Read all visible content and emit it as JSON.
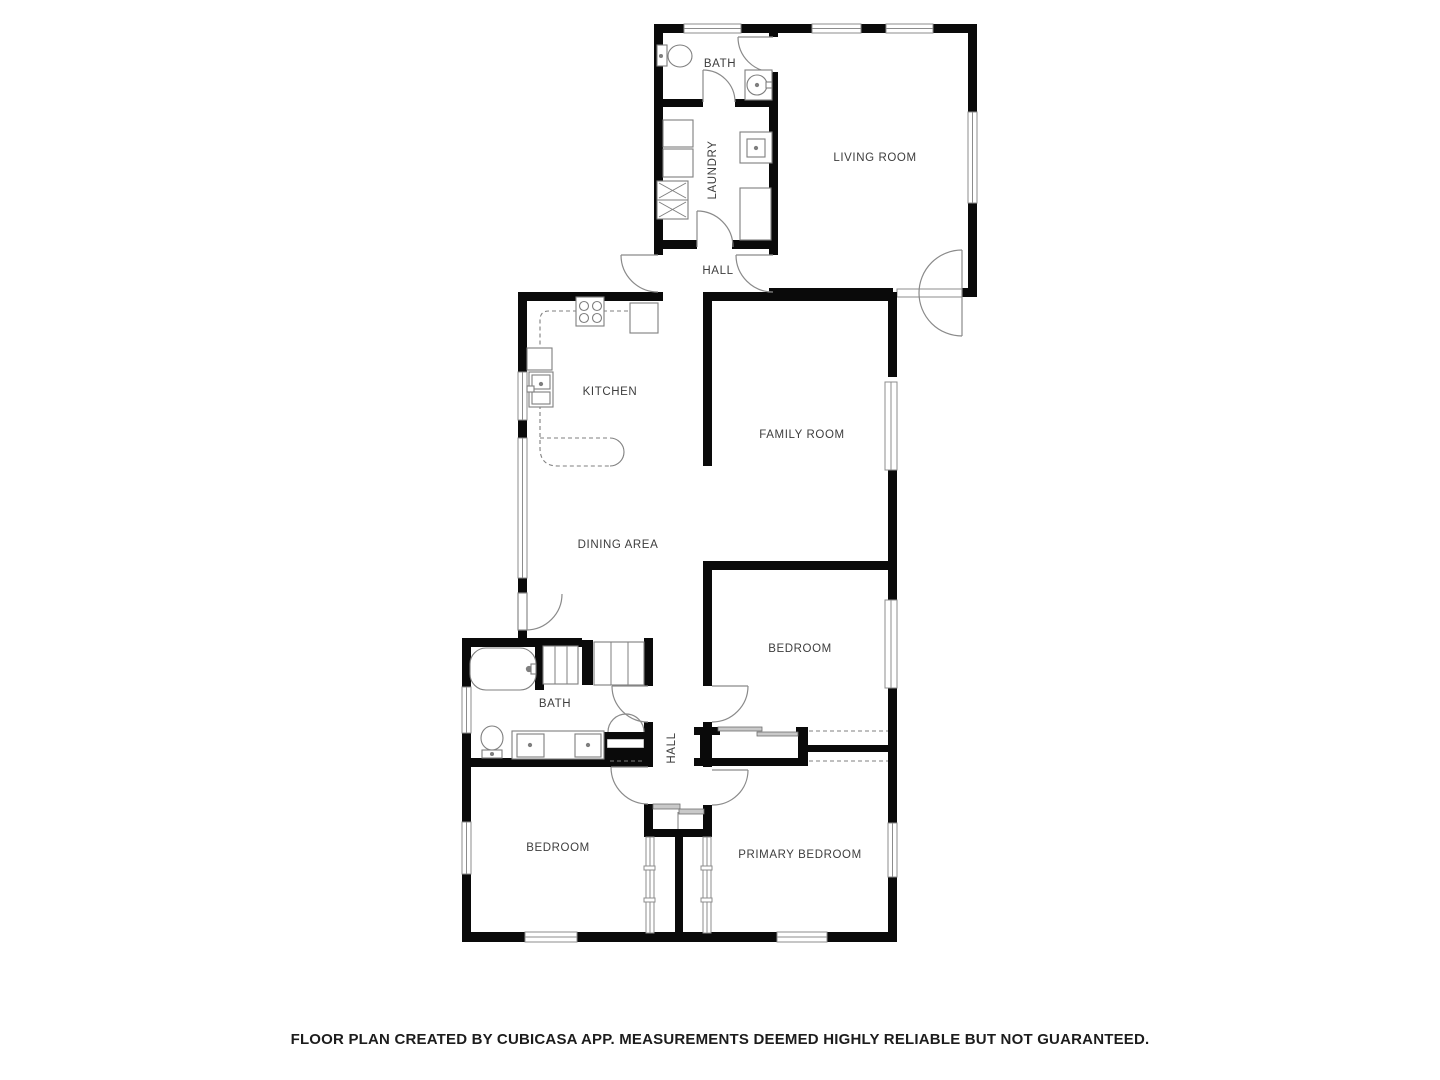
{
  "footer": {
    "disclaimer": "FLOOR PLAN CREATED BY CUBICASA APP. MEASUREMENTS DEEMED HIGHLY RELIABLE BUT NOT GUARANTEED."
  },
  "floorplan": {
    "canvas": {
      "width": 1440,
      "height": 1080
    },
    "colors": {
      "wall": "#0a0a0a",
      "window_stroke": "#8c8c8c",
      "door": "#8a8a8a",
      "fixture": "#7f7f7f",
      "label": "#3d3d3d",
      "slider_fill": "#c9c9c9",
      "background": "#ffffff"
    },
    "rooms": [
      {
        "id": "bath-upper",
        "label": "BATH",
        "x": 720,
        "y": 67,
        "rotate": 0
      },
      {
        "id": "laundry",
        "label": "LAUNDRY",
        "x": 716,
        "y": 170,
        "rotate": -90
      },
      {
        "id": "living-room",
        "label": "LIVING ROOM",
        "x": 875,
        "y": 161,
        "rotate": 0
      },
      {
        "id": "hall-upper",
        "label": "HALL",
        "x": 718,
        "y": 274,
        "rotate": 0
      },
      {
        "id": "kitchen",
        "label": "KITCHEN",
        "x": 610,
        "y": 395,
        "rotate": 0
      },
      {
        "id": "family-room",
        "label": "FAMILY ROOM",
        "x": 802,
        "y": 438,
        "rotate": 0
      },
      {
        "id": "dining-area",
        "label": "DINING AREA",
        "x": 618,
        "y": 548,
        "rotate": 0
      },
      {
        "id": "bedroom-right",
        "label": "BEDROOM",
        "x": 800,
        "y": 652,
        "rotate": 0
      },
      {
        "id": "bath-lower",
        "label": "BATH",
        "x": 555,
        "y": 707,
        "rotate": 0
      },
      {
        "id": "hall-lower",
        "label": "HALL",
        "x": 675,
        "y": 748,
        "rotate": -90
      },
      {
        "id": "bedroom-left",
        "label": "BEDROOM",
        "x": 558,
        "y": 851,
        "rotate": 0
      },
      {
        "id": "primary-bedroom",
        "label": "PRIMARY BEDROOM",
        "x": 800,
        "y": 858,
        "rotate": 0
      }
    ],
    "walls": [
      [
        654,
        24,
        30,
        9
      ],
      [
        741,
        24,
        71,
        9
      ],
      [
        861,
        24,
        25,
        9
      ],
      [
        933,
        24,
        44,
        9
      ],
      [
        654,
        24,
        9,
        231
      ],
      [
        769,
        24,
        9,
        13
      ],
      [
        769,
        72,
        9,
        183
      ],
      [
        769,
        288,
        9,
        9
      ],
      [
        654,
        99,
        49,
        8
      ],
      [
        735,
        99,
        43,
        8
      ],
      [
        654,
        240,
        43,
        9
      ],
      [
        732,
        240,
        46,
        9
      ],
      [
        968,
        24,
        9,
        88
      ],
      [
        968,
        203,
        9,
        85
      ],
      [
        962,
        288,
        15,
        9
      ],
      [
        778,
        288,
        115,
        9
      ],
      [
        703,
        292,
        190,
        9
      ],
      [
        518,
        292,
        145,
        9
      ],
      [
        518,
        292,
        9,
        80
      ],
      [
        518,
        420,
        9,
        18
      ],
      [
        518,
        578,
        9,
        15
      ],
      [
        518,
        630,
        9,
        17
      ],
      [
        703,
        292,
        9,
        174
      ],
      [
        888,
        292,
        9,
        85
      ],
      [
        888,
        470,
        9,
        100
      ],
      [
        703,
        561,
        194,
        9
      ],
      [
        703,
        561,
        9,
        125
      ],
      [
        703,
        722,
        9,
        45
      ],
      [
        703,
        805,
        9,
        32
      ],
      [
        888,
        570,
        9,
        30
      ],
      [
        888,
        688,
        9,
        135
      ],
      [
        888,
        877,
        9,
        55
      ],
      [
        694,
        727,
        26,
        8
      ],
      [
        796,
        727,
        12,
        8
      ],
      [
        694,
        758,
        114,
        8
      ],
      [
        808,
        745,
        89,
        7
      ],
      [
        700,
        727,
        8,
        39
      ],
      [
        798,
        727,
        10,
        39
      ],
      [
        644,
        638,
        9,
        48
      ],
      [
        644,
        722,
        9,
        45
      ],
      [
        644,
        804,
        9,
        33
      ],
      [
        645,
        829,
        67,
        8
      ],
      [
        462,
        638,
        120,
        9
      ],
      [
        582,
        640,
        11,
        45
      ],
      [
        535,
        640,
        9,
        50
      ],
      [
        462,
        645,
        9,
        42
      ],
      [
        462,
        733,
        9,
        89
      ],
      [
        462,
        874,
        9,
        58
      ],
      [
        462,
        758,
        182,
        9
      ],
      [
        598,
        732,
        9,
        31
      ],
      [
        598,
        732,
        55,
        7
      ],
      [
        598,
        748,
        55,
        10
      ],
      [
        675,
        837,
        8,
        98
      ],
      [
        462,
        932,
        63,
        10
      ],
      [
        577,
        932,
        200,
        10
      ],
      [
        827,
        932,
        70,
        10
      ]
    ],
    "windows": [
      [
        684,
        24,
        57,
        9
      ],
      [
        812,
        24,
        49,
        9
      ],
      [
        886,
        24,
        47,
        9
      ],
      [
        968,
        112,
        9,
        91
      ],
      [
        885,
        382,
        12,
        88
      ],
      [
        885,
        600,
        12,
        88
      ],
      [
        888,
        823,
        9,
        54
      ],
      [
        518,
        372,
        9,
        48
      ],
      [
        518,
        438,
        9,
        140
      ],
      [
        462,
        687,
        9,
        46
      ],
      [
        462,
        822,
        9,
        52
      ],
      [
        525,
        932,
        52,
        10
      ],
      [
        777,
        932,
        50,
        10
      ],
      [
        646,
        837,
        8,
        96
      ],
      [
        703,
        837,
        8,
        96
      ]
    ],
    "openings": [
      [
        897,
        289,
        65,
        8
      ],
      [
        607,
        739,
        37,
        9
      ]
    ],
    "door_panels": [
      [
        518,
        593,
        9,
        37
      ]
    ],
    "doors": [
      {
        "name": "door-living-bath",
        "leaf": [
          773,
          37,
          738,
          37
        ],
        "arcs": [
          "M738,37 A35,35 0 0 0 773,72"
        ]
      },
      {
        "name": "door-laundry-bath",
        "leaf": [
          703,
          102,
          703,
          70
        ],
        "arcs": [
          "M703,70 A32,32 0 0 1 735,102"
        ]
      },
      {
        "name": "door-hall-laundry",
        "leaf": [
          697,
          247,
          697,
          211
        ],
        "arcs": [
          "M697,211 A36,36 0 0 1 733,247"
        ]
      },
      {
        "name": "door-hall-exterior",
        "leaf": [
          658,
          255,
          621,
          255
        ],
        "arcs": [
          "M621,255 A37,37 0 0 0 658,292"
        ]
      },
      {
        "name": "door-hall-living",
        "leaf": [
          773,
          255,
          736,
          255
        ],
        "arcs": [
          "M736,255 A37,37 0 0 0 773,292"
        ]
      },
      {
        "name": "door-living-double",
        "leaf": [
          962,
          250,
          962,
          336
        ],
        "arcs": [
          "M919,293 A43,43 0 0 1 962,250",
          "M919,293 A43,43 0 0 0 962,336"
        ]
      },
      {
        "name": "door-dining-exterior",
        "leaf": null,
        "arcs": [
          "M562,594 A36,36 0 0 1 526,630"
        ]
      },
      {
        "name": "door-bedroom-right",
        "leaf": [
          712,
          686,
          748,
          686
        ],
        "arcs": [
          "M748,686 A36,36 0 0 1 712,722"
        ]
      },
      {
        "name": "door-hall-bath-lower",
        "leaf": [
          648,
          686,
          612,
          686
        ],
        "arcs": [
          "M612,686 A36,36 0 0 0 648,722"
        ]
      },
      {
        "name": "door-bedroom-left",
        "leaf": [
          648,
          767,
          611,
          767
        ],
        "arcs": [
          "M611,767 A37,37 0 0 0 648,804"
        ]
      },
      {
        "name": "door-primary-bedroom",
        "leaf": [
          712,
          770,
          748,
          770
        ],
        "arcs": [
          "M748,770 A35,35 0 0 1 712,805"
        ]
      },
      {
        "name": "bifold-closet-door",
        "leaf": null,
        "arcs": [
          "M608,732 A18,18 0 0 1 626,714",
          "M644,732 A18,18 0 0 0 626,714"
        ]
      }
    ],
    "dashes": [
      "M603,311 L630,311",
      "M577,311 L549,311 Q540,311 540,320 L540,348",
      "M540,405 L540,448 Q540,466 558,466 L610,466",
      "M540,438 L610,438",
      "M596,664 L642,664",
      "M809,731 L888,731",
      "M809,761 L888,761",
      "M610,761 L643,761"
    ],
    "solid_thin": [
      "M610,438 A14,14 0 0 1 610,466"
    ],
    "sliding_doors": [
      [
        718,
        727,
        44,
        4
      ],
      [
        757,
        732,
        41,
        4
      ],
      [
        653,
        804,
        27,
        5
      ],
      [
        679,
        809,
        25,
        5
      ]
    ],
    "ticks": [
      [
        644,
        866,
        11,
        4
      ],
      [
        644,
        898,
        11,
        4
      ],
      [
        701,
        866,
        11,
        4
      ],
      [
        701,
        898,
        11,
        4
      ]
    ],
    "fixtures": [
      {
        "name": "toilet-upper",
        "shapes": [
          {
            "t": "rect",
            "x": 657,
            "y": 45,
            "w": 10,
            "h": 21
          },
          {
            "t": "ellipse",
            "cx": 680,
            "cy": 56,
            "rx": 12,
            "ry": 11
          },
          {
            "t": "circle",
            "cx": 661,
            "cy": 56,
            "r": 1.5
          }
        ]
      },
      {
        "name": "sink-upper-bath",
        "shapes": [
          {
            "t": "rect",
            "x": 745,
            "y": 70,
            "w": 27,
            "h": 30
          },
          {
            "t": "circle",
            "cx": 757,
            "cy": 85,
            "r": 10
          },
          {
            "t": "circle",
            "cx": 757,
            "cy": 85,
            "r": 1.6
          },
          {
            "t": "rect",
            "x": 766,
            "y": 82,
            "w": 6,
            "h": 6
          }
        ]
      },
      {
        "name": "laundry-cabinet-1",
        "shapes": [
          {
            "t": "rect",
            "x": 663,
            "y": 120,
            "w": 30,
            "h": 27
          }
        ]
      },
      {
        "name": "laundry-cabinet-2",
        "shapes": [
          {
            "t": "rect",
            "x": 663,
            "y": 149,
            "w": 30,
            "h": 28
          }
        ]
      },
      {
        "name": "washer-dryer",
        "shapes": [
          {
            "t": "rect",
            "x": 657,
            "y": 181,
            "w": 31,
            "h": 38
          },
          {
            "t": "line",
            "x1": 657,
            "y1": 200,
            "x2": 688,
            "y2": 200
          },
          {
            "t": "line",
            "x1": 659,
            "y1": 183,
            "x2": 686,
            "y2": 198
          },
          {
            "t": "line",
            "x1": 686,
            "y1": 183,
            "x2": 659,
            "y2": 198
          },
          {
            "t": "line",
            "x1": 659,
            "y1": 202,
            "x2": 686,
            "y2": 217
          },
          {
            "t": "line",
            "x1": 686,
            "y1": 202,
            "x2": 659,
            "y2": 217
          }
        ]
      },
      {
        "name": "laundry-sink",
        "shapes": [
          {
            "t": "rect",
            "x": 740,
            "y": 132,
            "w": 32,
            "h": 31
          },
          {
            "t": "rect",
            "x": 747,
            "y": 139,
            "w": 18,
            "h": 18
          },
          {
            "t": "circle",
            "cx": 756,
            "cy": 148,
            "r": 1.6
          }
        ]
      },
      {
        "name": "laundry-tall-cabinet",
        "shapes": [
          {
            "t": "rect",
            "x": 740,
            "y": 188,
            "w": 31,
            "h": 52
          }
        ]
      },
      {
        "name": "stove",
        "shapes": [
          {
            "t": "rect",
            "x": 576,
            "y": 297,
            "w": 28,
            "h": 29
          },
          {
            "t": "circle",
            "cx": 584,
            "cy": 306,
            "r": 4.5
          },
          {
            "t": "circle",
            "cx": 597,
            "cy": 306,
            "r": 4.5
          },
          {
            "t": "circle",
            "cx": 584,
            "cy": 318,
            "r": 4.5
          },
          {
            "t": "circle",
            "cx": 597,
            "cy": 318,
            "r": 4.5
          }
        ]
      },
      {
        "name": "refrigerator",
        "shapes": [
          {
            "t": "rect",
            "x": 630,
            "y": 303,
            "w": 28,
            "h": 30
          }
        ]
      },
      {
        "name": "kitchen-counter",
        "shapes": [
          {
            "t": "rect",
            "x": 527,
            "y": 348,
            "w": 25,
            "h": 22
          }
        ]
      },
      {
        "name": "kitchen-sink",
        "shapes": [
          {
            "t": "rect",
            "x": 529,
            "y": 372,
            "w": 24,
            "h": 35
          },
          {
            "t": "rect",
            "x": 532,
            "y": 375,
            "w": 18,
            "h": 14
          },
          {
            "t": "rect",
            "x": 532,
            "y": 392,
            "w": 18,
            "h": 12
          },
          {
            "t": "circle",
            "cx": 541,
            "cy": 384,
            "r": 1.6
          },
          {
            "t": "rect",
            "x": 527,
            "y": 386,
            "w": 7,
            "h": 6
          }
        ]
      },
      {
        "name": "bathtub",
        "shapes": [
          {
            "t": "rect",
            "x": 470,
            "y": 648,
            "w": 66,
            "h": 42,
            "rx": 16
          },
          {
            "t": "circle",
            "cx": 529,
            "cy": 669,
            "r": 2.6
          },
          {
            "t": "rect",
            "x": 531,
            "y": 664,
            "w": 5,
            "h": 10
          }
        ]
      },
      {
        "name": "linen-closet",
        "shapes": [
          {
            "t": "rect",
            "x": 543,
            "y": 646,
            "w": 35,
            "h": 38
          },
          {
            "t": "line",
            "x1": 555,
            "y1": 646,
            "x2": 555,
            "y2": 684
          },
          {
            "t": "line",
            "x1": 567,
            "y1": 646,
            "x2": 567,
            "y2": 684
          }
        ]
      },
      {
        "name": "dining-closet",
        "shapes": [
          {
            "t": "rect",
            "x": 594,
            "y": 642,
            "w": 50,
            "h": 43
          },
          {
            "t": "line",
            "x1": 611,
            "y1": 642,
            "x2": 611,
            "y2": 685
          },
          {
            "t": "line",
            "x1": 628,
            "y1": 642,
            "x2": 628,
            "y2": 685
          }
        ]
      },
      {
        "name": "toilet-lower",
        "shapes": [
          {
            "t": "ellipse",
            "cx": 492,
            "cy": 738,
            "rx": 11,
            "ry": 12
          },
          {
            "t": "rect",
            "x": 482,
            "y": 750,
            "w": 20,
            "h": 8
          },
          {
            "t": "circle",
            "cx": 492,
            "cy": 754,
            "r": 1.5
          }
        ]
      },
      {
        "name": "vanity-double-sink",
        "shapes": [
          {
            "t": "rect",
            "x": 512,
            "y": 731,
            "w": 92,
            "h": 28
          },
          {
            "t": "rect",
            "x": 517,
            "y": 734,
            "w": 27,
            "h": 23
          },
          {
            "t": "circle",
            "cx": 530,
            "cy": 745,
            "r": 1.6
          },
          {
            "t": "rect",
            "x": 575,
            "y": 734,
            "w": 26,
            "h": 23
          },
          {
            "t": "circle",
            "cx": 588,
            "cy": 745,
            "r": 1.6
          }
        ]
      },
      {
        "name": "hall-closet-divider",
        "shapes": [
          {
            "t": "line",
            "x1": 678,
            "y1": 812,
            "x2": 678,
            "y2": 829
          }
        ]
      }
    ]
  }
}
